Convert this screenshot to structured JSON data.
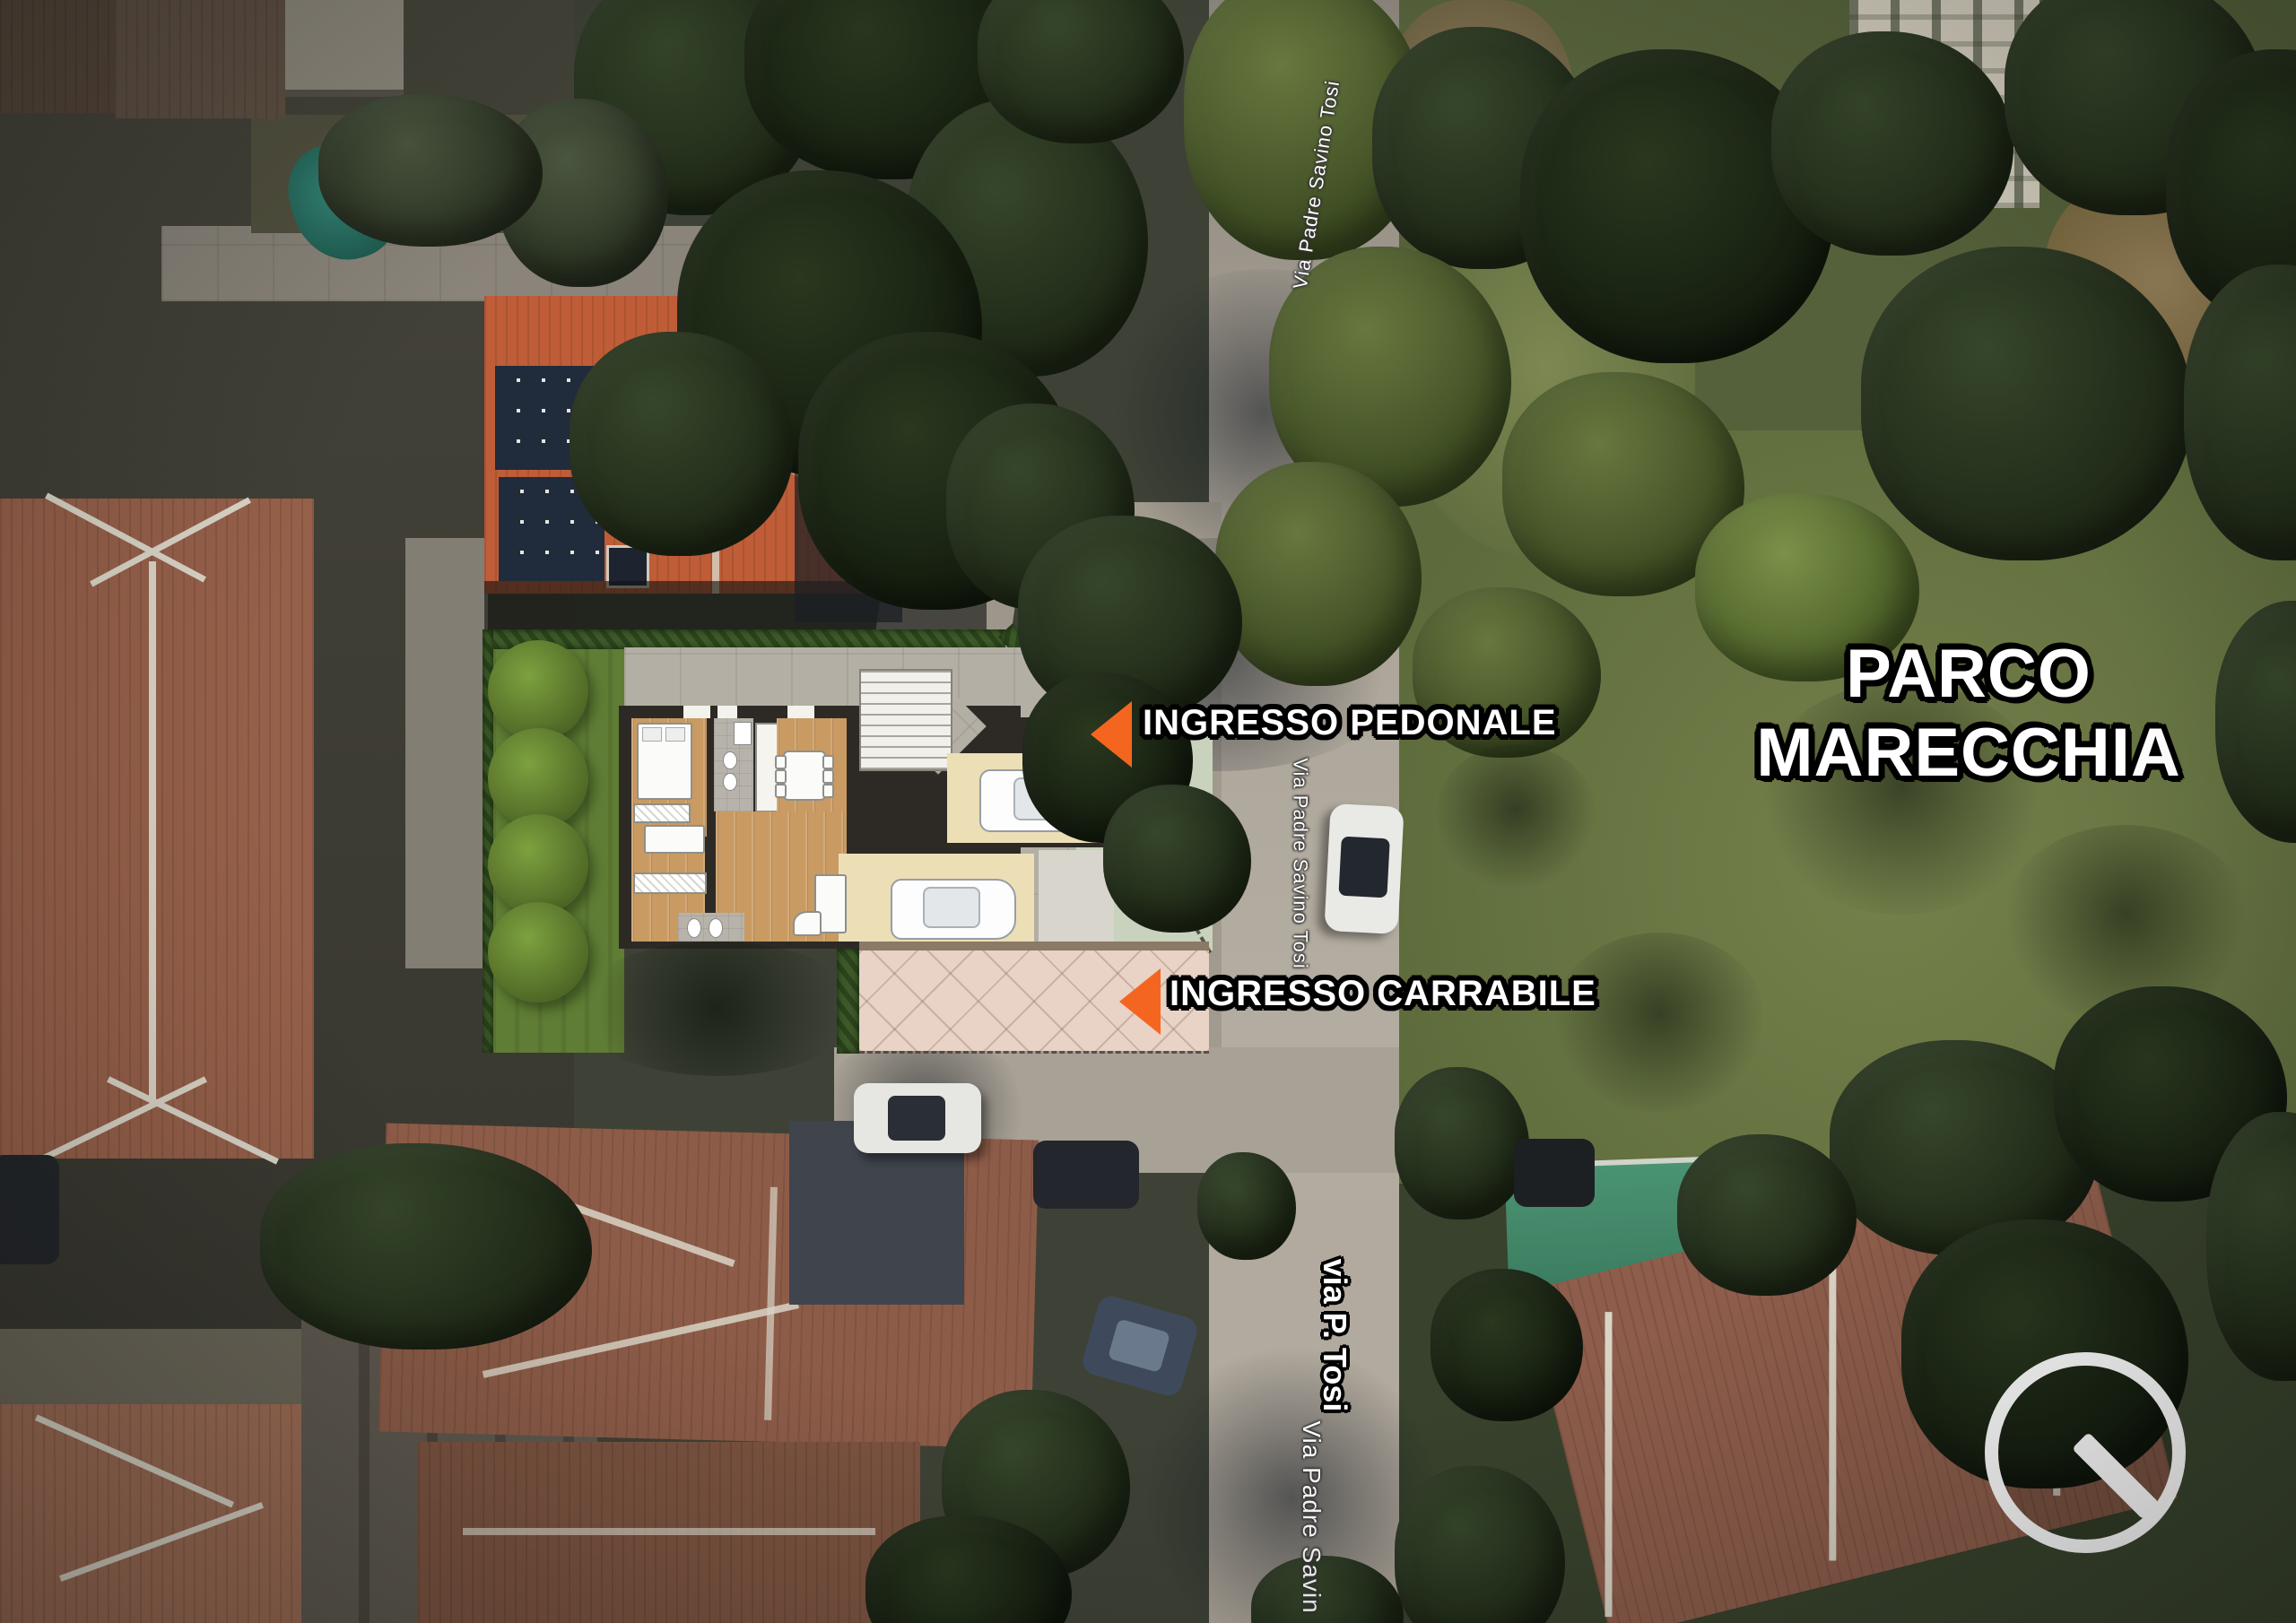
{
  "map_annotations": {
    "pedestrian_entrance": {
      "label": "INGRESSO PEDONALE"
    },
    "driveway_entrance": {
      "label": "INGRESSO CARRABILE"
    },
    "park": {
      "line1": "PARCO",
      "line2": "MARECCHIA"
    }
  },
  "street_labels": {
    "top_road": "Via Padre Savino Tosi",
    "mid_road": "Via Padre Savino Tosi",
    "cross_street": "via P. Tosi",
    "bottom_road": "Via Padre Savin"
  },
  "colors": {
    "entrance_arrow": "#F4661F",
    "label_text": "#FFFFFF",
    "label_outline": "#000000",
    "street_label_text": "#FFFFFF"
  },
  "icons": {
    "compass": "north-indicator-circle-needle"
  }
}
